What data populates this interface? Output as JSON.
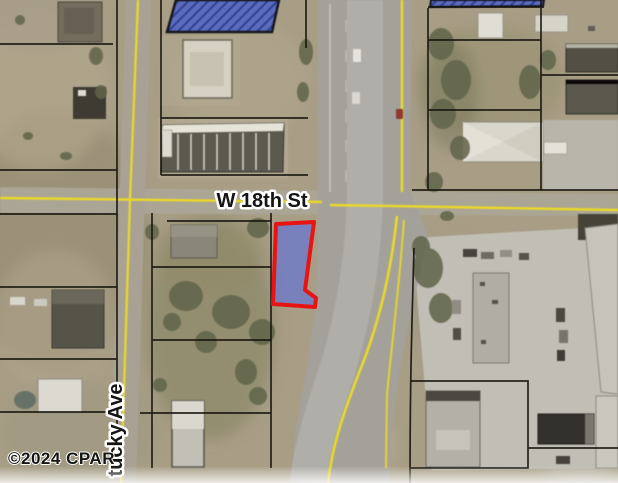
{
  "map": {
    "description": "Aerial parcel map with a highlighted lot on the southeast corner of W 18th St",
    "watermark": "©2024 CPAR",
    "streets": {
      "horizontal": "W 18th St",
      "vertical": "tucky Ave"
    },
    "highlight": {
      "outline_color": "#e81414",
      "fill_color": "#6b79c8"
    },
    "colors": {
      "selection_building_blue": "#5b6bbf",
      "road_centerline_yellow": "#ead928",
      "parcel_line": "#18160f",
      "terrain_tan": "#a89e86"
    }
  }
}
